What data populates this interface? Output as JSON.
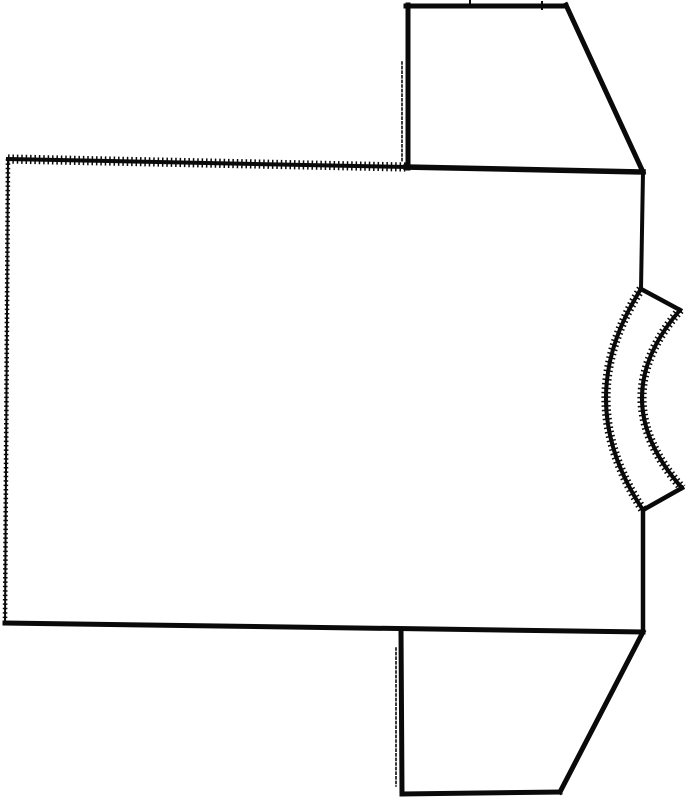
{
  "canvas": {
    "width": 687,
    "height": 800,
    "background_color": "#ffffff",
    "ink_color": "#0a0a0a"
  },
  "figure": {
    "subject_label": "sideways-tshirt-pattern-line-drawing",
    "parts": [
      "body-panel",
      "top-sleeve",
      "bottom-sleeve",
      "neckband"
    ]
  },
  "drawing": {
    "stroke_color": "#0a0a0a",
    "textures": {
      "serrated_overlay_width_factor": 2.3,
      "serrated_dasharray": "1.5 2.9",
      "dotted_dasharray": "2 2.6"
    },
    "paths": [
      {
        "name": "body-top-edge-serrated",
        "part": "body-panel",
        "d": "M8,159 L406,167",
        "width": 4,
        "texture": "serrated"
      },
      {
        "name": "body-left-edge-stitched",
        "part": "body-panel",
        "d": "M8,159 L5,623",
        "width": 2,
        "texture": "serrated-thin"
      },
      {
        "name": "body-bottom-edge",
        "part": "body-panel",
        "d": "M5,623 L643,632",
        "width": 5,
        "texture": "solid"
      },
      {
        "name": "body-right-edge-upper",
        "part": "body-panel",
        "d": "M643,172 L641,289",
        "width": 4,
        "texture": "solid"
      },
      {
        "name": "body-right-edge-lower",
        "part": "body-panel",
        "d": "M643,510 L643,632",
        "width": 4.5,
        "texture": "solid"
      },
      {
        "name": "body-shoulder-seam",
        "part": "body-panel",
        "d": "M406,167 L643,172",
        "width": 5.5,
        "texture": "solid"
      },
      {
        "name": "top-sleeve-left-edge",
        "part": "top-sleeve",
        "d": "M408,5 L408,168",
        "width": 5,
        "texture": "solid"
      },
      {
        "name": "top-sleeve-fold-line",
        "part": "top-sleeve",
        "d": "M402,62 L402,162",
        "width": 1.6,
        "texture": "dotted"
      },
      {
        "name": "top-sleeve-top-edge",
        "part": "top-sleeve",
        "d": "M406,6 L566,6",
        "width": 5,
        "texture": "solid"
      },
      {
        "name": "top-sleeve-notch-1",
        "part": "top-sleeve",
        "d": "M470,0 L470,7",
        "width": 2,
        "texture": "solid"
      },
      {
        "name": "top-sleeve-notch-2",
        "part": "top-sleeve",
        "d": "M542,2 L542,9",
        "width": 2,
        "texture": "solid"
      },
      {
        "name": "top-sleeve-diagonal-edge",
        "part": "top-sleeve",
        "d": "M566,5 L643,172",
        "width": 5,
        "texture": "solid"
      },
      {
        "name": "bottom-sleeve-left-edge",
        "part": "bottom-sleeve",
        "d": "M401,630 L402,794",
        "width": 5,
        "texture": "solid"
      },
      {
        "name": "bottom-sleeve-fold-line",
        "part": "bottom-sleeve",
        "d": "M396,648 L396,786",
        "width": 1.6,
        "texture": "dotted"
      },
      {
        "name": "bottom-sleeve-bottom-edge",
        "part": "bottom-sleeve",
        "d": "M402,794 L560,792",
        "width": 5,
        "texture": "solid"
      },
      {
        "name": "bottom-sleeve-diagonal-edge",
        "part": "bottom-sleeve",
        "d": "M560,792 L643,632",
        "width": 5,
        "texture": "solid"
      },
      {
        "name": "neckband-top-cap",
        "part": "neckband",
        "d": "M641,289 L680,310",
        "width": 4.5,
        "texture": "solid"
      },
      {
        "name": "neckband-inner-curve",
        "part": "neckband",
        "d": "M641,289 Q570,400 643,510",
        "width": 4,
        "texture": "serrated"
      },
      {
        "name": "neckband-outer-curve",
        "part": "neckband",
        "d": "M680,310 Q603,399 682,488",
        "width": 4,
        "texture": "serrated"
      },
      {
        "name": "neckband-bottom-cap",
        "part": "neckband",
        "d": "M643,510 L682,488",
        "width": 4.5,
        "texture": "solid"
      }
    ]
  }
}
